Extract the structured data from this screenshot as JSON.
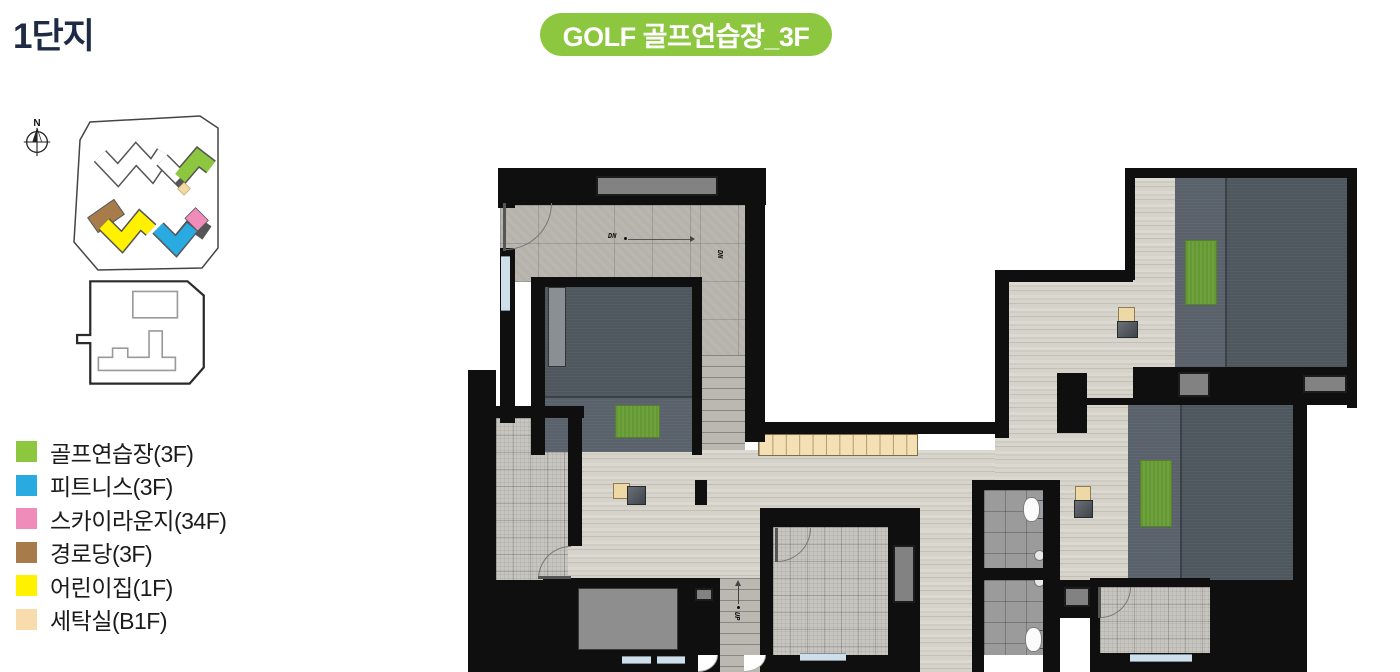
{
  "page": {
    "title": "1단지",
    "badge_label": "GOLF 골프연습장_3F"
  },
  "compass": {
    "label": "N"
  },
  "legend": {
    "items": [
      {
        "label": "골프연습장(3F)",
        "color": "#8dc63f"
      },
      {
        "label": "피트니스(3F)",
        "color": "#29abe2"
      },
      {
        "label": "스카이라운지(34F)",
        "color": "#f08cba"
      },
      {
        "label": "경로당(3F)",
        "color": "#a87c4a"
      },
      {
        "label": "어린이집(1F)",
        "color": "#fff100"
      },
      {
        "label": "세탁실(B1F)",
        "color": "#f8dcab"
      }
    ]
  },
  "plan": {
    "labels": {
      "dn": "DN",
      "up": "UP"
    }
  },
  "colors": {
    "badge_bg": "#8dc63f",
    "title_text": "#1f2a44",
    "wall": "#0f0f0f",
    "golf_mat": "#6ea23b"
  }
}
